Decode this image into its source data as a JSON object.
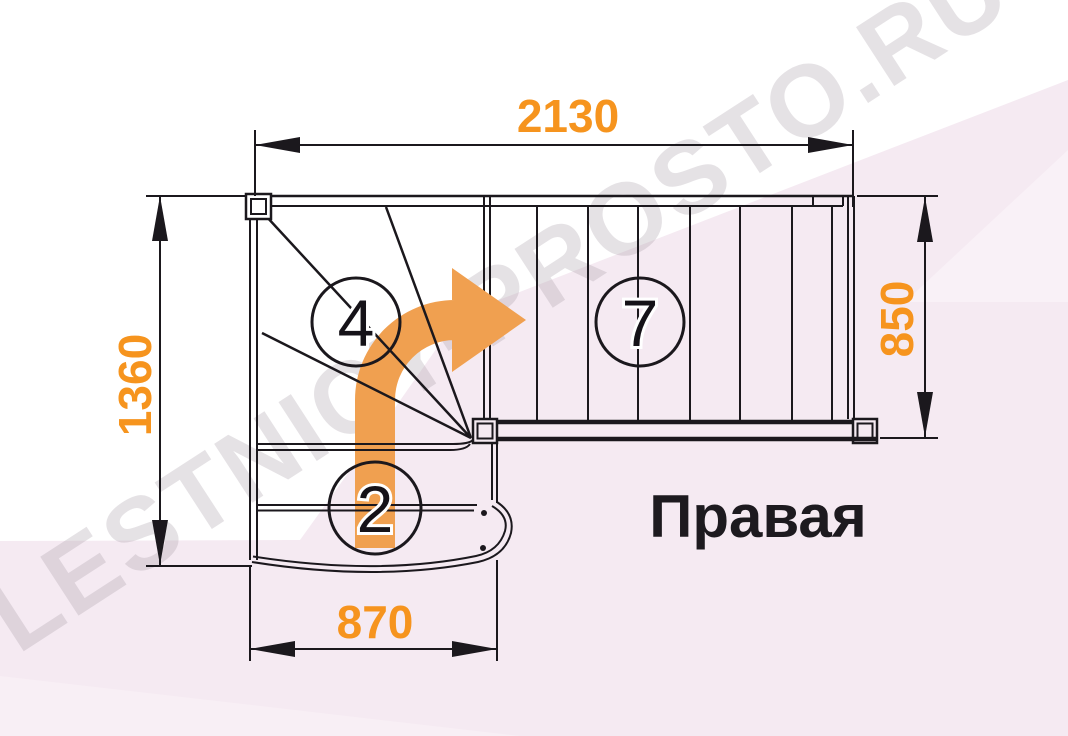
{
  "diagram": {
    "type_label": "staircase-plan-top-view",
    "direction_label": "Правая",
    "watermark": "LESTNICY-PROSTO.RU",
    "dimensions_mm": {
      "top": "2130",
      "left": "1360",
      "right": "850",
      "bottom": "870"
    },
    "step_counts": {
      "winder_section": "4",
      "upper_flight": "7",
      "lower_flight": "2"
    },
    "colors": {
      "dimension_text": "#f6941e",
      "direction_arrow": "#f0a050",
      "linework": "#1b181d",
      "background_pink": "#f5eaf2",
      "background_pink_light": "#f9f1f7",
      "watermark_gray": "rgba(160,150,160,0.28)"
    }
  }
}
